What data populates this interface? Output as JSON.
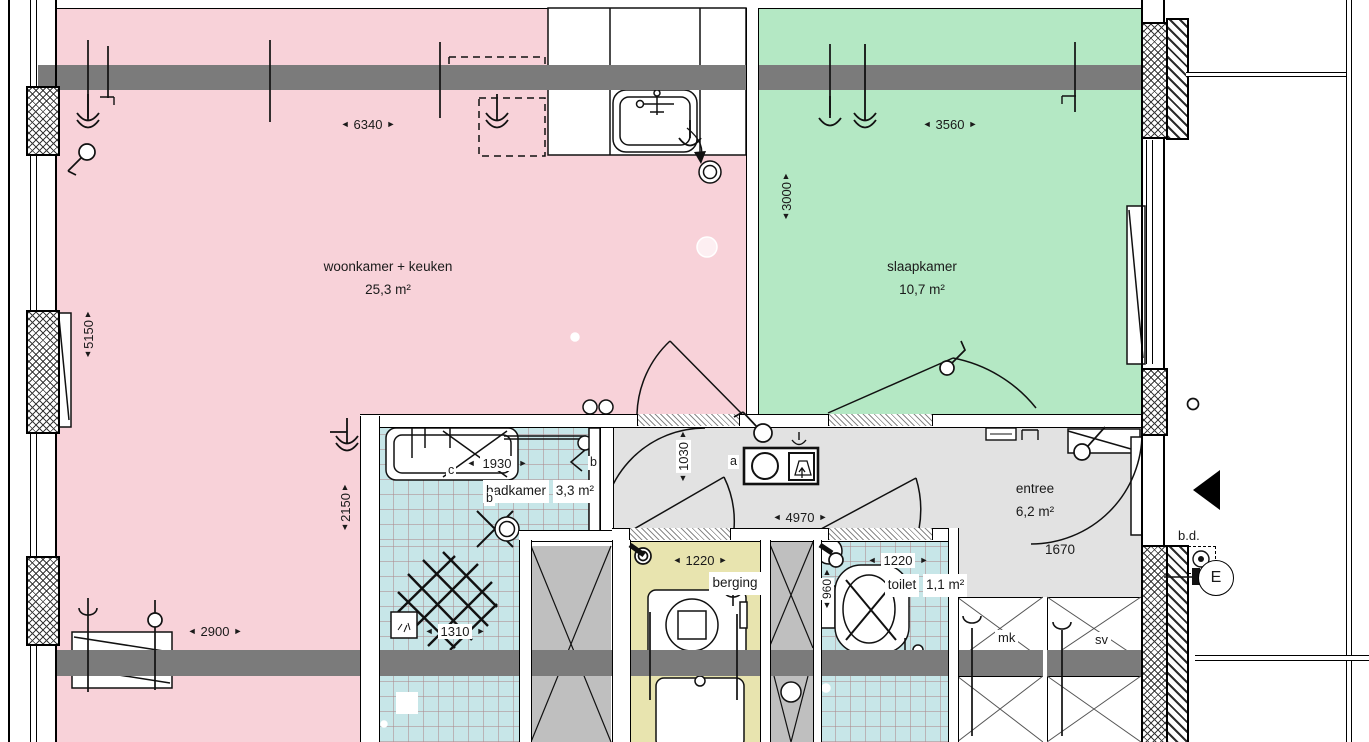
{
  "rooms": {
    "woonkamer": {
      "name": "woonkamer + keuken",
      "area": "25,3 m²"
    },
    "slaapkamer": {
      "name": "slaapkamer",
      "area": "10,7 m²"
    },
    "badkamer": {
      "name": "badkamer",
      "area": "3,3 m²"
    },
    "berging": {
      "name": "berging"
    },
    "toilet": {
      "name": "toilet",
      "area": "1,1 m²"
    },
    "entree": {
      "name": "entree",
      "area": "6,2 m²"
    }
  },
  "dims": {
    "woonkamer_width": "6340",
    "slaapkamer_width": "3560",
    "slaapkamer_depth": "3000",
    "woonkamer_depth": "5150",
    "badkamer_zone_depth": "2150",
    "woonkamer_bottom": "2900",
    "badkamer_width": "1930",
    "shower_width": "1310",
    "hall_depth": "1030",
    "hall_width": "4970",
    "berging_width": "1220",
    "toilet_width": "1220",
    "toilet_depth": "960",
    "entree_width": "1670"
  },
  "annotations": {
    "mk": "mk",
    "sv": "sv",
    "bd": "b.d.",
    "meter": "E",
    "switch_a": "a",
    "switch_b1": "b",
    "switch_b2": "b",
    "switch_c": "c"
  },
  "icons": {
    "arrow_left": "◄",
    "arrow_right": "►",
    "arrow_up": "▲",
    "arrow_down": "▼"
  },
  "colors": {
    "living": "#f8d2d9",
    "bedroom": "#b4e8c4",
    "bath": "#c7e6e8",
    "storage": "#e8e4af",
    "hall": "#e2e2e2",
    "slab": "#7b7b7b",
    "shaft": "#bfbfbf"
  }
}
